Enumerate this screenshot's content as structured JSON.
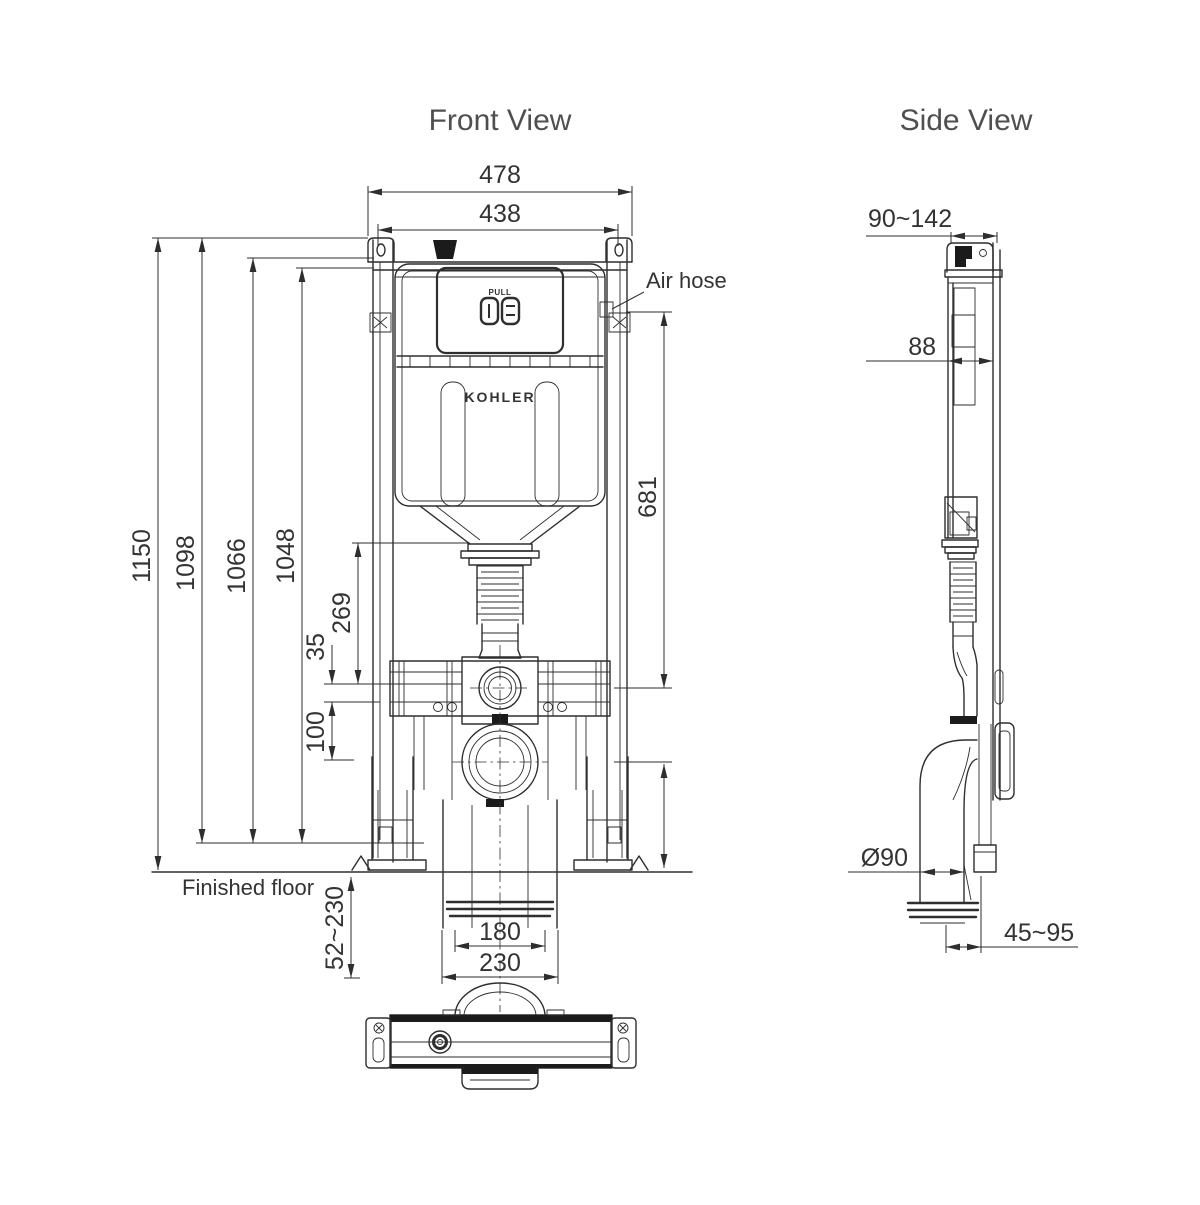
{
  "front_view": {
    "title": "Front View",
    "brand": "KOHLER",
    "button_label": "PULL",
    "annotations": {
      "air_hose": "Air hose",
      "finished_floor": "Finished floor"
    },
    "dimensions": {
      "overall_width": "478",
      "mounting_width": "438",
      "overall_height": "1150",
      "frame_height": "1098",
      "height_1066": "1066",
      "height_1048": "1048",
      "flush_bend_offset": "269",
      "offset_35": "35",
      "outlet_offset": "100",
      "air_hose_height": "681",
      "pipe_width_inner": "180",
      "pipe_width_outer": "230",
      "floor_adjust_range": "52~230"
    }
  },
  "side_view": {
    "title": "Side View",
    "dimensions": {
      "depth_range": "90~142",
      "depth_88": "88",
      "outlet_diameter": "Ø90",
      "outlet_distance_range": "45~95"
    }
  }
}
